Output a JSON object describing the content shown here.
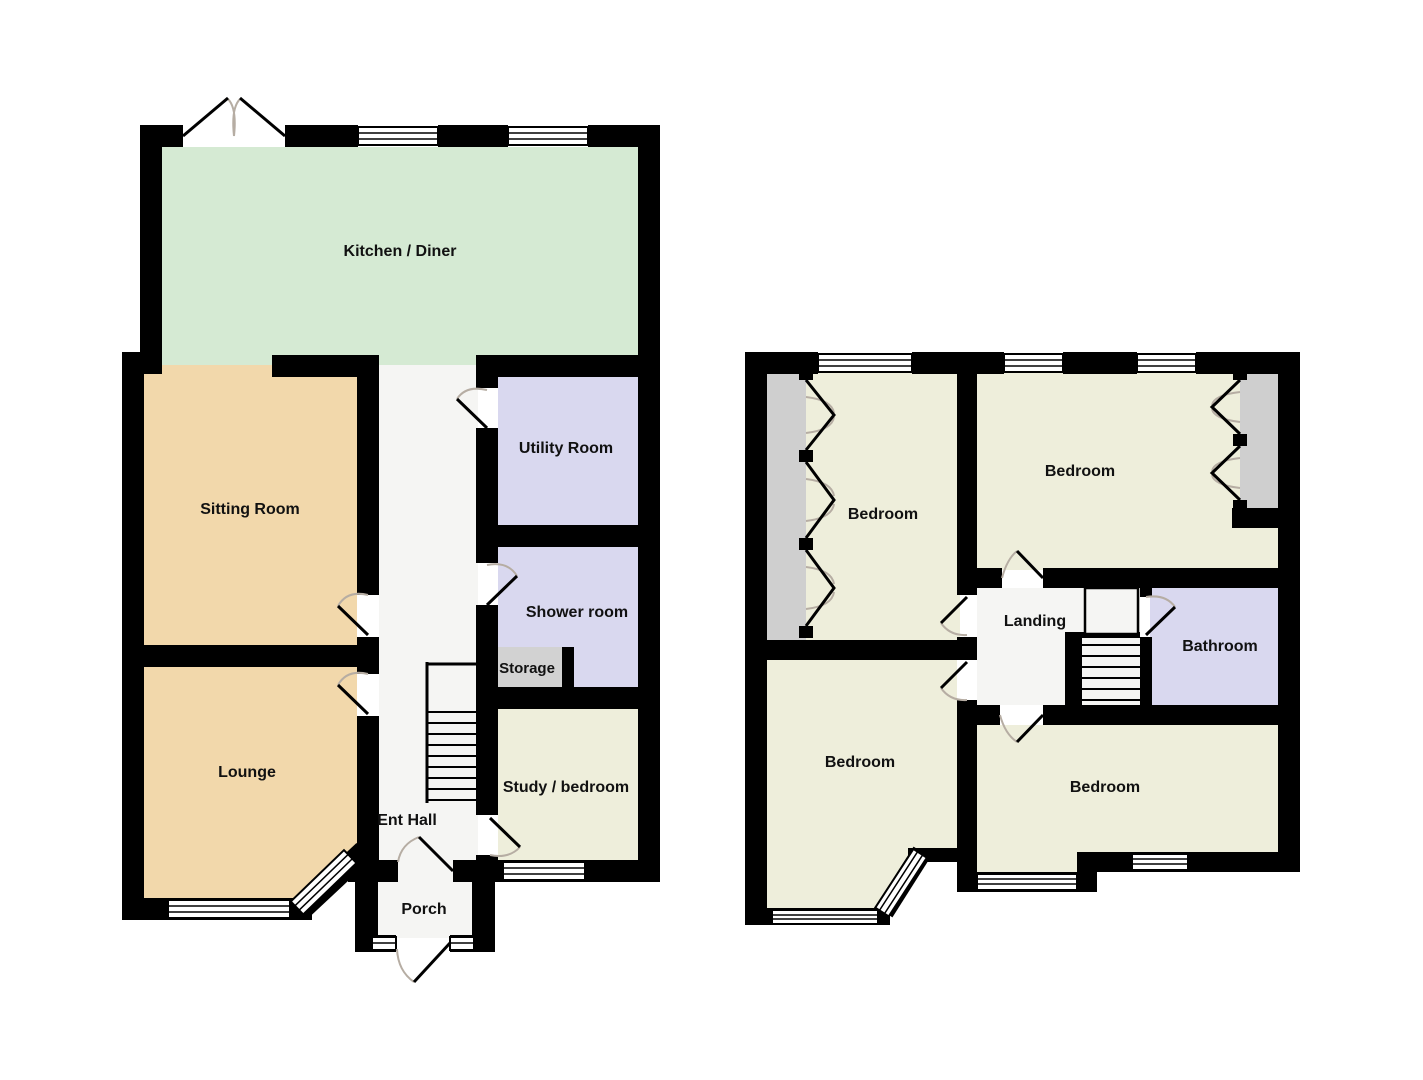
{
  "palette": {
    "wall": "#000000",
    "kitchen_fill": "#d5ead3",
    "reception_fill": "#f2d8ab",
    "wet_room_fill": "#d9d8ef",
    "bedroom_fill": "#eeeedb",
    "hall_fill": "#f5f5f3",
    "storage_fill": "#d2d2d2",
    "wardrobe_fill": "#cfcfcf",
    "door_arc": "#b6ada3",
    "label_text": "#111111",
    "background": "#ffffff"
  },
  "ground_floor": {
    "rooms": {
      "kitchen_diner": "Kitchen / Diner",
      "sitting_room": "Sitting Room",
      "utility_room": "Utility Room",
      "shower_room": "Shower room",
      "storage": "Storage",
      "lounge": "Lounge",
      "ent_hall": "Ent Hall",
      "study_bedroom": "Study / bedroom",
      "porch": "Porch"
    }
  },
  "first_floor": {
    "rooms": {
      "bedroom_front_left": "Bedroom",
      "bedroom_front_right": "Bedroom",
      "bedroom_back_left": "Bedroom",
      "bedroom_back_right": "Bedroom",
      "landing": "Landing",
      "bathroom": "Bathroom"
    }
  }
}
